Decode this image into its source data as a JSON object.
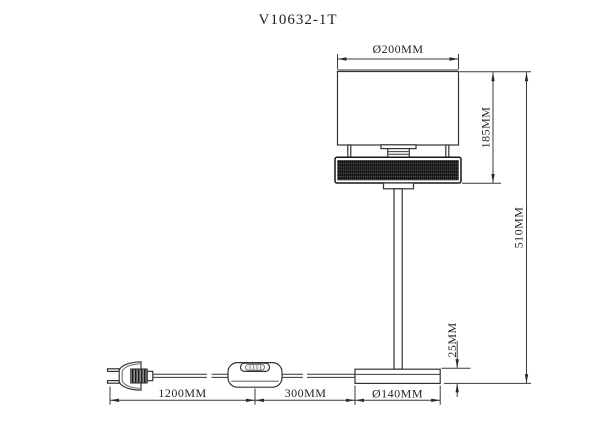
{
  "title": "V10632-1T",
  "drawing": {
    "type": "table-lamp dimension drawing",
    "dimensions": {
      "shade_diameter": "Ø200MM",
      "shade_height": "185MM",
      "total_height": "510MM",
      "base_thickness": "25MM",
      "plug_to_switch": "1200MM",
      "switch_to_base": "300MM",
      "base_diameter": "Ø140MM"
    }
  },
  "colors": {
    "background": "#ffffff",
    "line": "#333333",
    "text": "#1f1f1f",
    "band_mesh_dark": "#232323",
    "band_mesh_light": "#4c4c4c",
    "shade_fold": "#9a9a9a"
  }
}
